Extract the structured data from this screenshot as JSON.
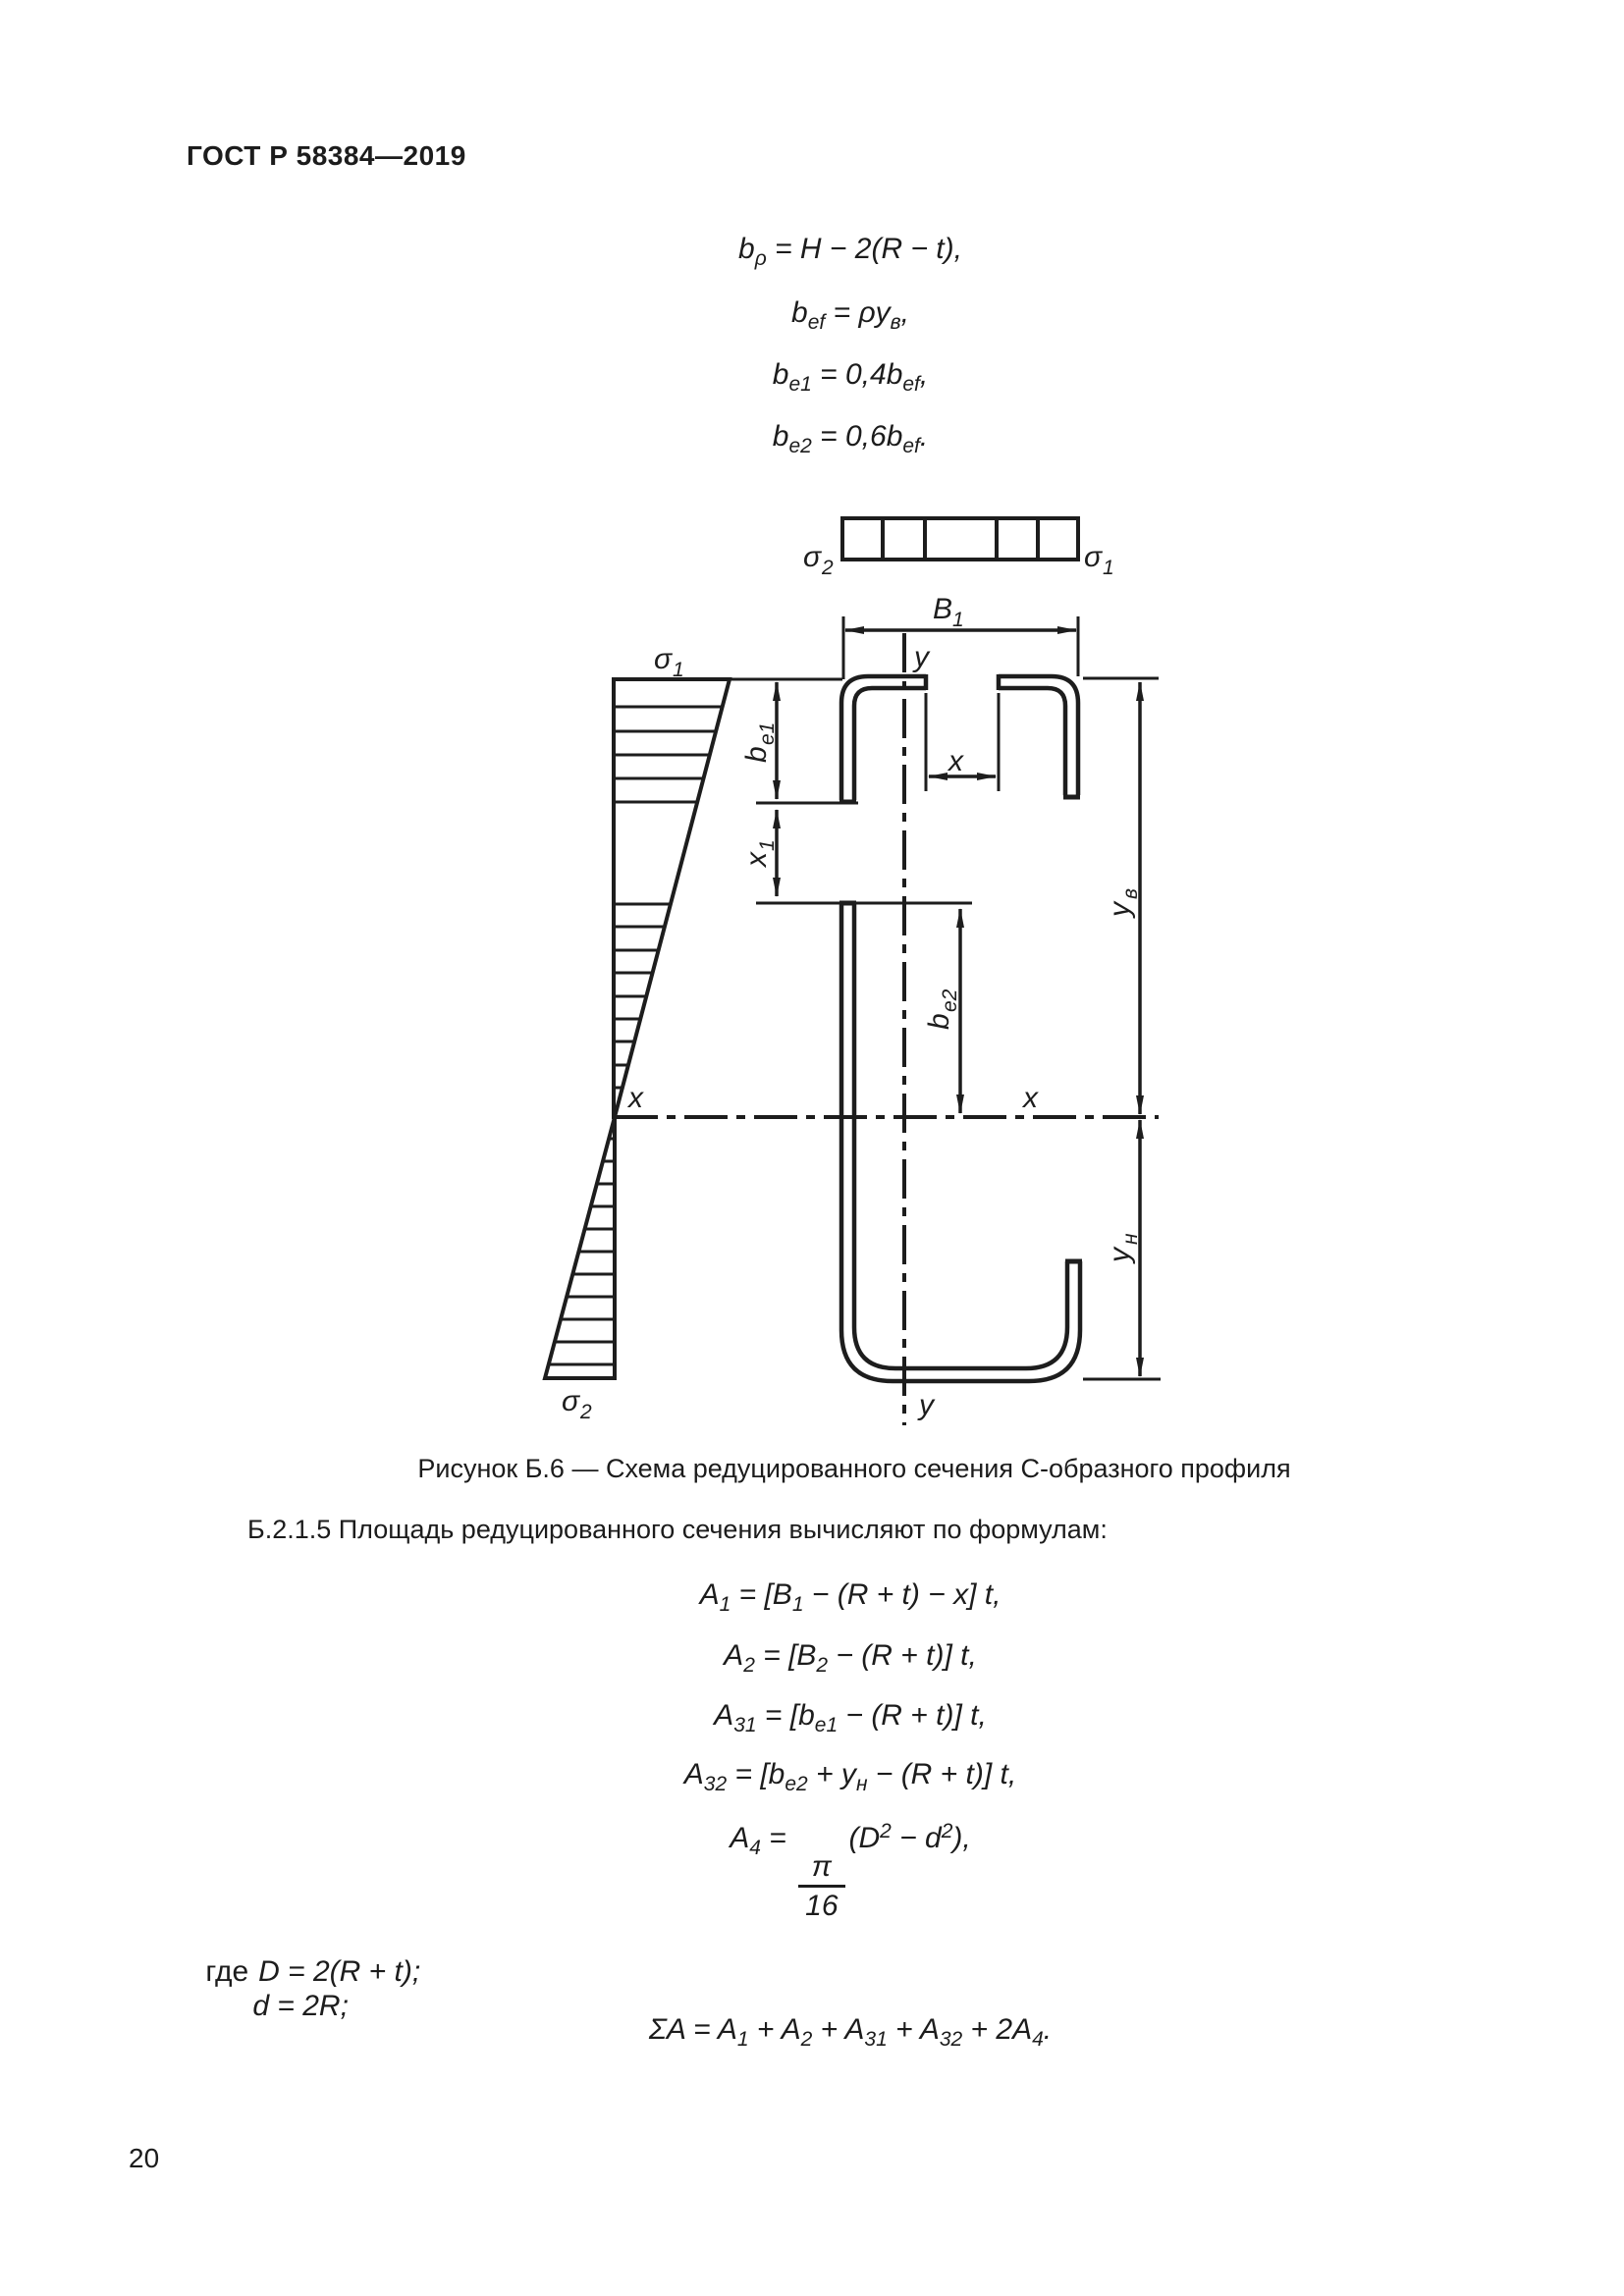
{
  "page": {
    "header": "ГОСТ Р 58384—2019",
    "page_number": "20"
  },
  "formulas_top": {
    "f1": "b_{ρ} = H − 2(R − t),",
    "f2": "b_{ef} = ρy_{в},",
    "f3": "b_{e1} = 0,4b_{ef},",
    "f4": "b_{e2} = 0,6b_{ef}."
  },
  "figure": {
    "caption": "Рисунок Б.6 — Схема редуцированного сечения С-образного профиля",
    "labels": {
      "sigma2_strip": {
        "main": "σ",
        "sub": "2"
      },
      "sigma1_strip": {
        "main": "σ",
        "sub": "1"
      },
      "B1": {
        "main": "B",
        "sub": "1"
      },
      "y_top": {
        "main": "y"
      },
      "y_bottom": {
        "main": "y"
      },
      "sigma1_stress": {
        "main": "σ",
        "sub": "1"
      },
      "sigma2_stress": {
        "main": "σ",
        "sub": "2"
      },
      "x_gap": {
        "main": "x"
      },
      "x_axis_left": {
        "main": "x"
      },
      "x_axis_right": {
        "main": "x"
      },
      "be1": {
        "main": "b",
        "sub": "e1"
      },
      "x1": {
        "main": "x",
        "sub": "1"
      },
      "be2": {
        "main": "b",
        "sub": "e2"
      },
      "yv": {
        "main": "y",
        "sub": "в"
      },
      "yn": {
        "main": "y",
        "sub": "н"
      }
    }
  },
  "section": {
    "paragraph": "Б.2.1.5 Площадь редуцированного сечения вычисляют по формулам:",
    "f_a1": "A_{1} = [B_{1} − (R + t) − x] t,",
    "f_a2": "A_{2} = [B_{2} − (R + t)] t,",
    "f_a31": "A_{31} = [b_{e1} − (R + t)] t,",
    "f_a32": "A_{32} = [b_{e2} + y_{н} − (R + t)] t,",
    "f_a4": "A_{4} = @{π|16}(D^{2} − d^{2}),",
    "where_label": "где",
    "where_d1": "D = 2(R + t);",
    "where_d2": "d = 2R;",
    "f_sum": "ΣA = A_{1} + A_{2} + A_{31} + A_{32} + 2A_{4}."
  }
}
